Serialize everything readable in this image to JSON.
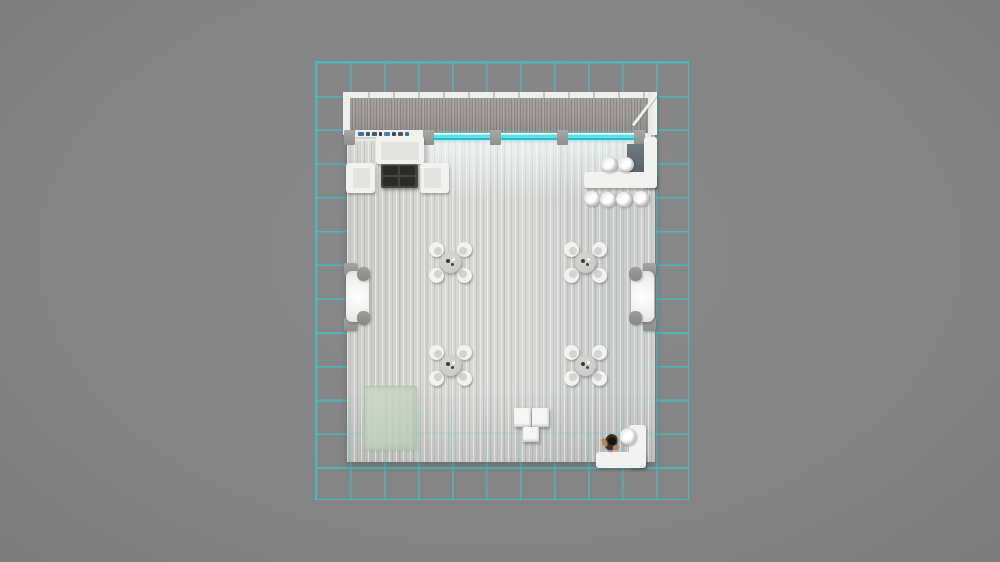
{
  "scene": {
    "description": "Top-down 3D render of an exhibition booth floor plan on a cyan layout grid",
    "canvas": {
      "width": 1000,
      "height": 562
    },
    "colors": {
      "ground": "#848484",
      "grid_line": "rgba(64,193,197,0.8)",
      "floor_left": "#cdcecb",
      "floor_mid": "#d8d9d6",
      "floor_right": "#c9cccb",
      "wood": "#9c9a95",
      "frame_white": "#efefed",
      "light_cyan": "#5fe3e8",
      "light_cyan_pale": "#aef4f6",
      "furniture_white": "#f2f2f0",
      "furniture_seat": "#e3e3e0",
      "dark_table": "#39393714",
      "coffee_table": "rgba(55,55,53,0.92)",
      "coffee_cushion": "#2a2a28",
      "round_table": "#cbcbc8",
      "back_panel_top": "#6e7980",
      "back_panel_bottom": "#59646b",
      "rug_green_a": "rgba(206,219,199,0.85)",
      "rug_green_b": "rgba(187,203,181,0.8)",
      "person_body": "#3a3028",
      "person_head": "#15120f",
      "person_skin": "#b5855e"
    }
  },
  "grid": {
    "x": 315,
    "y": 61,
    "width": 374,
    "height": 439,
    "cols": 11,
    "rows": 13,
    "cell_w": 34.0,
    "cell_h": 33.77,
    "line_w": 1.6
  },
  "booth": {
    "floor": {
      "x": 347,
      "y": 133,
      "width": 308,
      "height": 329
    },
    "floor_faint_grid": {
      "x": 347,
      "y": 384,
      "width": 308,
      "height": 78,
      "offset_x": 2,
      "offset_y": 14.7,
      "opacity": 0.22
    },
    "canopy": {
      "x": 343,
      "y": 92,
      "width": 314,
      "height": 43,
      "frame_top_h": 6,
      "frame_left_w": 7,
      "frame_right_w": 9
    },
    "brace": {
      "x": 633,
      "y": 124,
      "length": 38,
      "thickness": 3,
      "angle_deg": -53
    },
    "light_row": {
      "base": {
        "x": 349,
        "y": 133,
        "width": 302,
        "height": 8
      },
      "posts_x": [
        344,
        423,
        490,
        557,
        634
      ],
      "post": {
        "y": 130,
        "width": 11,
        "height": 15
      },
      "cyan_segments": [
        {
          "x": 434,
          "width": 56
        },
        {
          "x": 501,
          "width": 56
        },
        {
          "x": 568,
          "width": 66
        }
      ],
      "segment_y": 133,
      "segment_h": 7,
      "glow_y": 141,
      "glow_h": 62
    },
    "shelf": {
      "x": 355,
      "y": 130,
      "width": 68,
      "height": 7,
      "items": [
        {
          "dx": 3,
          "w": 6,
          "color": "#3a6fa8"
        },
        {
          "dx": 11,
          "w": 4,
          "color": "#2c5a8f"
        },
        {
          "dx": 17,
          "w": 5,
          "color": "#44546a"
        },
        {
          "dx": 24,
          "w": 3,
          "color": "#333b44"
        },
        {
          "dx": 29,
          "w": 6,
          "color": "#4a7fb5"
        },
        {
          "dx": 37,
          "w": 4,
          "color": "#2f4e75"
        },
        {
          "dx": 43,
          "w": 5,
          "color": "#555555"
        },
        {
          "dx": 50,
          "w": 4,
          "color": "#3a6fa8"
        }
      ]
    }
  },
  "furniture": {
    "lounge": {
      "sofa": {
        "x": 376,
        "y": 136,
        "width": 48,
        "height": 28
      },
      "sofa_seat": {
        "x": 381,
        "y": 142,
        "width": 38,
        "height": 18
      },
      "armchairs": [
        {
          "x": 346,
          "y": 163,
          "width": 29,
          "height": 30,
          "seat": {
            "x": 353,
            "y": 168,
            "width": 17,
            "height": 20
          }
        },
        {
          "x": 420,
          "y": 163,
          "width": 29,
          "height": 30,
          "seat": {
            "x": 424,
            "y": 168,
            "width": 17,
            "height": 20
          }
        }
      ],
      "coffee_table": {
        "x": 381,
        "y": 164,
        "width": 37,
        "height": 24
      }
    },
    "bar": {
      "back_panel": {
        "x": 627,
        "y": 144,
        "width": 18,
        "height": 29
      },
      "counter_vertical": {
        "x": 644,
        "y": 137,
        "width": 13,
        "height": 51
      },
      "counter_horizontal": {
        "x": 584,
        "y": 172,
        "width": 73,
        "height": 16
      },
      "stools_top": [
        [
          601,
          157
        ],
        [
          618,
          157
        ]
      ],
      "stools_bottom": [
        [
          584,
          191
        ],
        [
          600,
          192
        ],
        [
          616,
          192
        ],
        [
          633,
          191
        ]
      ],
      "stool_w": 16,
      "stool_h": 15
    },
    "dining_sets": {
      "centers": [
        [
          450,
          262
        ],
        [
          585,
          262
        ],
        [
          450,
          365
        ],
        [
          585,
          365
        ]
      ],
      "chair_dx": 14,
      "chair_dy": 13,
      "chair_size": 15,
      "table_diameter": 21
    },
    "side_sofas": [
      {
        "side": "left",
        "body": {
          "x": 346,
          "y": 271,
          "width": 23,
          "height": 51
        },
        "blocks": [
          {
            "x": 344,
            "y": 263,
            "width": 13,
            "height": 13
          },
          {
            "x": 344,
            "y": 318,
            "width": 13,
            "height": 13
          }
        ],
        "cushions": [
          {
            "x": 357,
            "y": 267,
            "width": 13,
            "height": 14
          },
          {
            "x": 357,
            "y": 311,
            "width": 13,
            "height": 14
          }
        ]
      },
      {
        "side": "right",
        "body": {
          "x": 631,
          "y": 271,
          "width": 23,
          "height": 51
        },
        "blocks": [
          {
            "x": 643,
            "y": 263,
            "width": 13,
            "height": 13
          },
          {
            "x": 643,
            "y": 318,
            "width": 13,
            "height": 13
          }
        ],
        "cushions": [
          {
            "x": 629,
            "y": 267,
            "width": 13,
            "height": 14
          },
          {
            "x": 629,
            "y": 311,
            "width": 13,
            "height": 14
          }
        ]
      }
    ],
    "rug": {
      "x": 364,
      "y": 386,
      "width": 53,
      "height": 64
    },
    "display_cubes": [
      {
        "x": 514,
        "y": 408,
        "width": 17,
        "height": 19
      },
      {
        "x": 532,
        "y": 408,
        "width": 17,
        "height": 19
      },
      {
        "x": 523,
        "y": 427,
        "width": 16,
        "height": 15
      }
    ],
    "reception": {
      "counter_vertical": {
        "x": 629,
        "y": 425,
        "width": 17,
        "height": 43
      },
      "counter_horizontal": {
        "x": 596,
        "y": 452,
        "width": 50,
        "height": 16
      },
      "stool": {
        "x": 620,
        "y": 428,
        "width": 16,
        "height": 17
      }
    },
    "person": {
      "x": 602,
      "y": 431,
      "width": 17,
      "height": 21
    }
  }
}
